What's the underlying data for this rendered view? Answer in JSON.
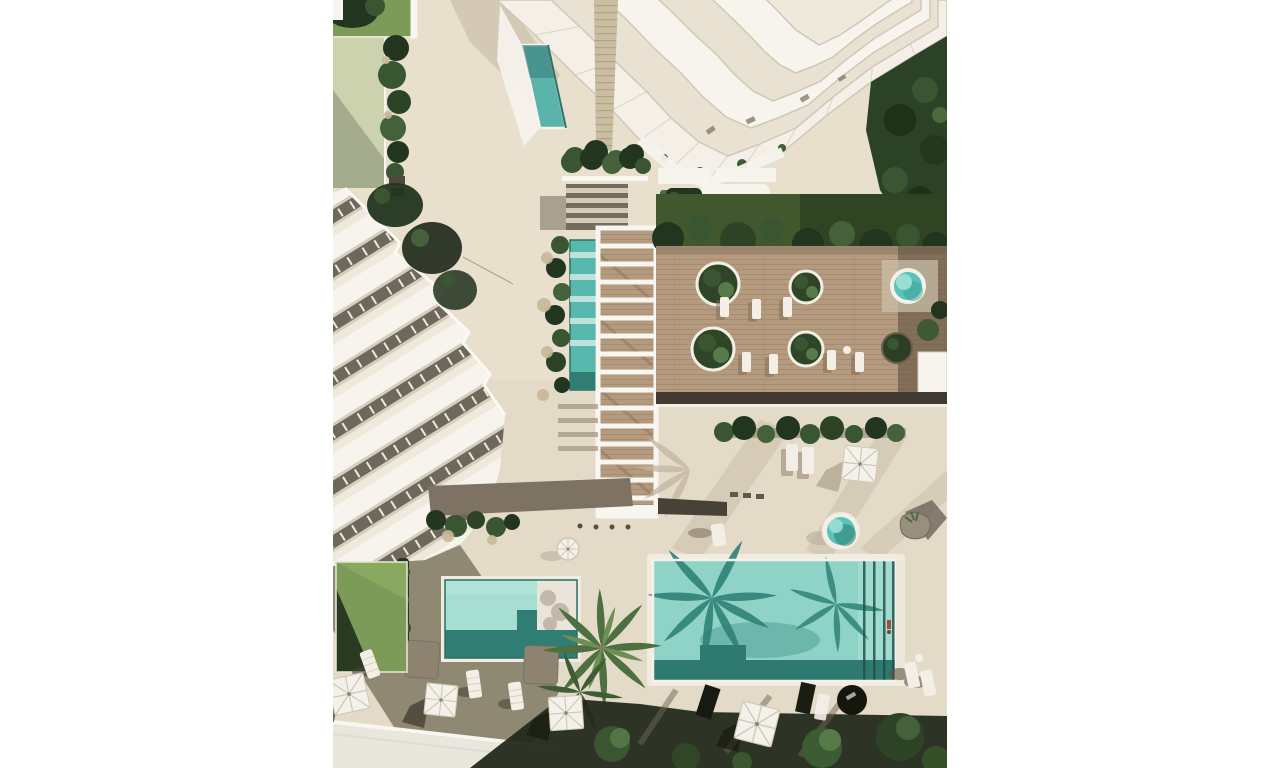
{
  "scene": {
    "type": "architectural-aerial-render",
    "description": "Top-down 3D rendering of a residential resort: terraced white tower (top), diagonal row building (left), slatted pergola walkway with lap pool (center), wood sun deck with round planters and loungers (right), main swimming pool and kids pool with palm shadows (bottom), hot tubs, square canvas umbrellas and gardens.",
    "visible_features": {
      "buildings": 2,
      "pools": 4,
      "hot_tubs": 2,
      "square_umbrellas": 4,
      "round_umbrellas": 1,
      "round_planters": 5,
      "sun_loungers_approx": 16,
      "palm_trees": 2
    }
  },
  "palette": {
    "page_bg": "#ffffff",
    "pavement": "#e8dfcd",
    "pavement_shade": "#dcd2bf",
    "pavement_shadow_soft": "#c3b7a1",
    "road": "#e9e6de",
    "curb": "#f8f6f0",
    "building_white": "#f7f4ee",
    "building_cream": "#efe9dc",
    "glass": "#e9e1d2",
    "seam": "#d5cdbd",
    "dark_band": "#6e675b",
    "spine_tan": "#c9bda2",
    "lawn": "#7c9a58",
    "lawn_dark": "#273621",
    "grass_band": "#41582e",
    "canopy_dark": "#22351f",
    "canopy_mid": "#3a5531",
    "canopy_light": "#547445",
    "deck_wood": "#b49a7e",
    "deck_plank_line": "#a68b6f",
    "deck_shadow": "#403a32",
    "walkway_taupe": "#7d7263",
    "walkway_dark": "#474136",
    "pergola_white": "#f8f6f1",
    "pergola_shadow": "#6b6156",
    "pool_water": "#8fd3c7",
    "pool_water_light": "#a5ded3",
    "pool_shadow": "#2f8177",
    "pool_dark_edge": "#2b6e66",
    "small_pool_water": "#a6ded3",
    "ledge_white": "#e9e5da",
    "hottub_water": "#58c3b8",
    "hottub_light": "#9fe2d8",
    "umbrella_white": "#f4f1ea",
    "umbrella_line": "#cfc8ba",
    "lounger_white": "#f3efe7",
    "shadow_dark": "#3f3a2e",
    "shadow_green_black": "#232a1c",
    "boulder_gray": "#98907e",
    "accent_red": "#a84b38"
  }
}
